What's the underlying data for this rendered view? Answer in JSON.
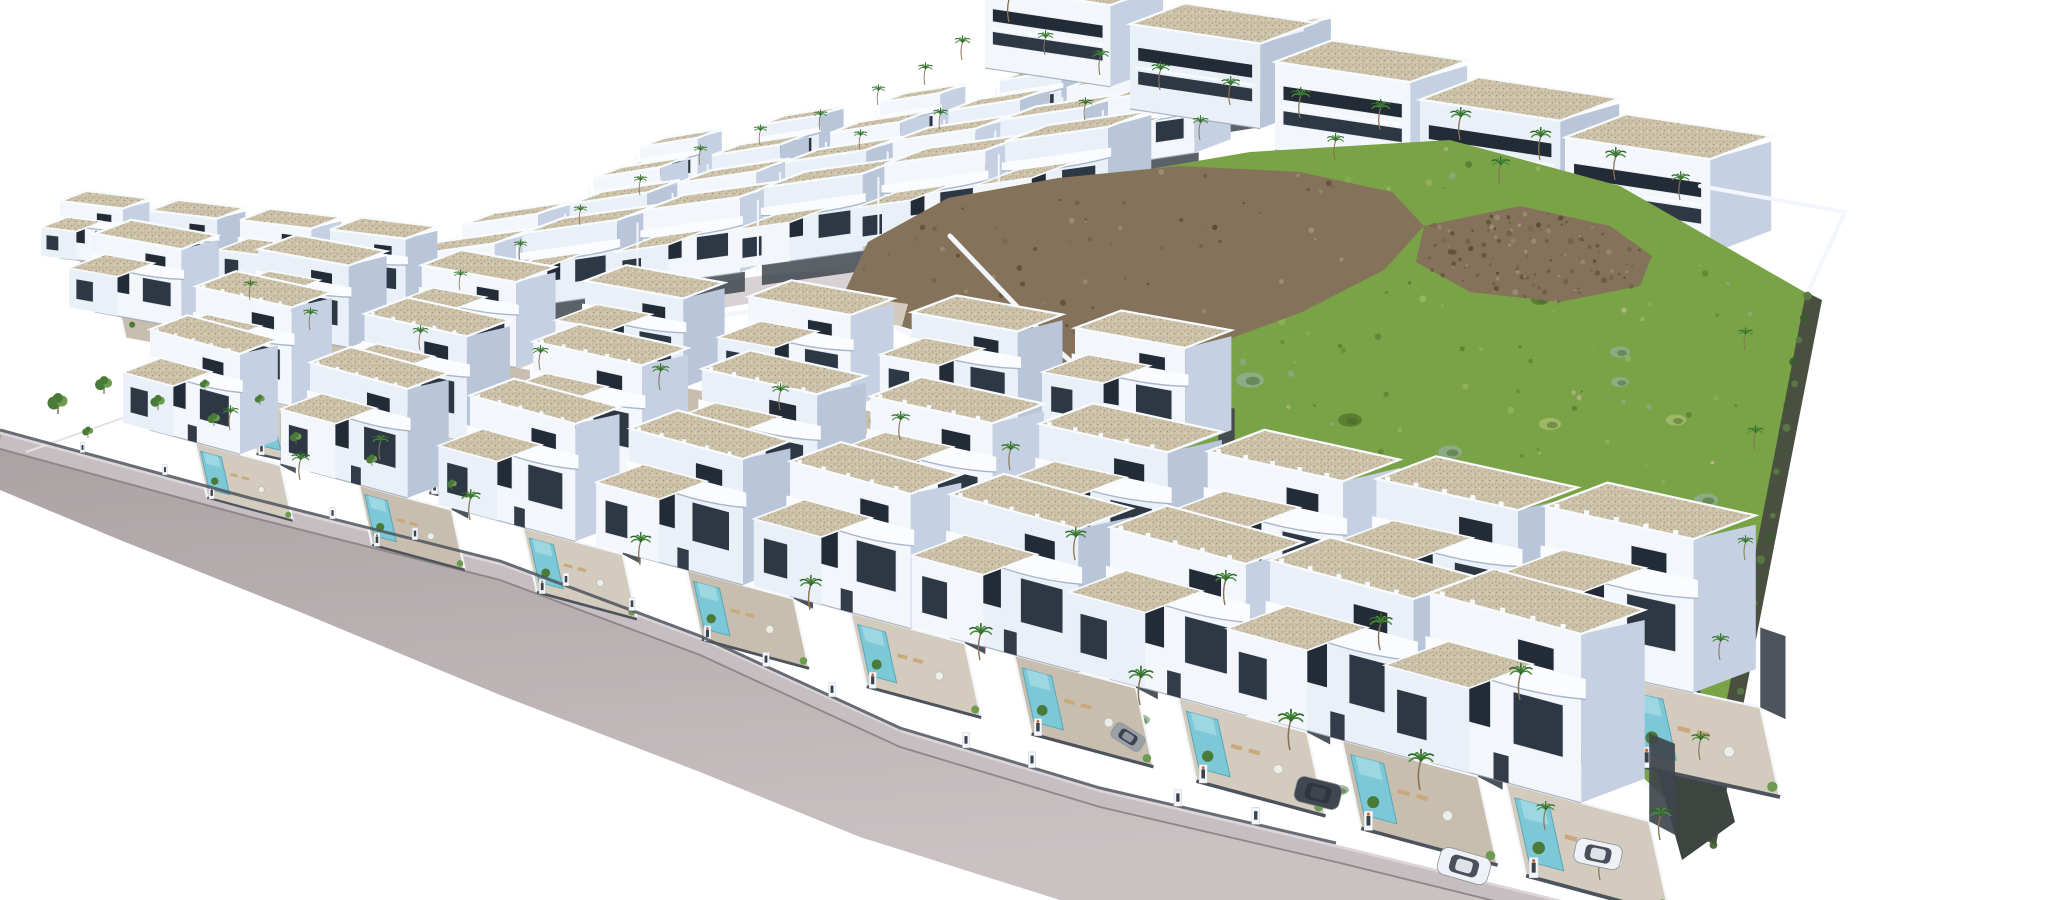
{
  "meta": {
    "description": "Aerial 3D architectural render of a coastal residential development: diagonal rows of white modern villas with gravel flat roofs, curved balconies, private turquoise pools and palm trees; a green undeveloped hillside lot with brown rocky outcrops on the right; a curving gray asphalt road along the lower-left edge; pure white background.",
    "canvas": {
      "w": 2048,
      "h": 900
    }
  },
  "palette": {
    "background": "#ffffff",
    "road_top": "#aaa1a3",
    "road_bottom": "#c9c1c2",
    "sidewalk": "#c6bec0",
    "curb": "#8f8688",
    "wall_base_line": "#ddd6d8",
    "inner_road": "#d8d2d4",
    "villa_front": "#f3f7fc",
    "villa_front_alt": "#eaf0f8",
    "villa_side": "#c5d1e2",
    "villa_side_alt": "#b9c6d9",
    "roof_gravel": "#cdc2aa",
    "parapet": "#f8fbfe",
    "base_shadow": "#98a3b2",
    "window": "#222b36",
    "window_alt": "#2e3844",
    "window_frame": "#e8edf4",
    "door": "#333c48",
    "balcony": "#fafcff",
    "balcony_shadow": "#a9b7c9",
    "fence": "#4d535d",
    "side_yard": "#3f454d",
    "pillar": "#f3f6fa",
    "pillar_slot": "#3a424c",
    "pillar_plant": "#c96a35",
    "paving": "#d3cbbd",
    "paving_alt": "#c7beb0",
    "pool": "#7cc8d6",
    "pool_light": "#aadde7",
    "pool_edge": "#58a8b8",
    "lounger": "#c9a87c",
    "table": "#eceee9",
    "field": "#7aa246",
    "field_dots": [
      "#55792f",
      "#93b05e",
      "#8fae8f",
      "#a6bc6c",
      "#c2b794",
      "#4f7430"
    ],
    "clump_colors": {
      "g": "#8fae8f",
      "d": "#55792f",
      "l": "#a6bc6c",
      "t": "#c2b794"
    },
    "rock": "#84735a",
    "rock_dots": [
      "#5d4f3c",
      "#a3927a",
      "#6e5f4a",
      "#57492f"
    ],
    "hedge": "#495040",
    "wedge": "#3e4440",
    "wall_white": "#f3f6fa",
    "palm_trunk": "#8a7355",
    "palm_dark": "#2e6629",
    "palm_light": "#4c8c3c",
    "tree": "#4a7a38",
    "tree_light": "#6d9c50",
    "car_colors": {
      "dark": "#41474e",
      "white": "#eef1f5",
      "gray": "#9aa0a6"
    },
    "car_glass": "#2b3340",
    "figure_colors": [
      "#8a4a3a",
      "#35507a",
      "#666666",
      "#7a6a4a"
    ]
  },
  "scene": {
    "road": {
      "top_edge": [
        [
          0,
          432
        ],
        [
          250,
          500
        ],
        [
          500,
          563
        ],
        [
          700,
          638
        ],
        [
          900,
          730
        ],
        [
          1100,
          790
        ],
        [
          1336,
          845
        ],
        [
          1560,
          900
        ]
      ],
      "bottom_edge": [
        [
          1060,
          900
        ],
        [
          860,
          837
        ],
        [
          700,
          772
        ],
        [
          500,
          695
        ],
        [
          300,
          612
        ],
        [
          120,
          540
        ],
        [
          0,
          490
        ]
      ]
    },
    "inner_road": {
      "path": "M 470,378 C 560,332 660,302 760,289 C 840,279 898,284 928,306 C 954,326 948,352 982,384 C 1008,408 1040,432 1078,456"
    },
    "curved_wall": {
      "path": "M 695,322 C 780,300 852,305 902,330 C 932,345 942,366 962,386"
    },
    "plaza": {
      "quad": [
        [
          852,
          296
        ],
        [
          908,
          304
        ],
        [
          902,
          326
        ],
        [
          846,
          318
        ]
      ],
      "figures": [
        [
          858,
          302
        ],
        [
          872,
          310
        ],
        [
          888,
          306
        ],
        [
          862,
          316
        ]
      ]
    },
    "field": {
      "outline": [
        [
          950,
          236
        ],
        [
          1050,
          186
        ],
        [
          1250,
          152
        ],
        [
          1450,
          140
        ],
        [
          1620,
          186
        ],
        [
          1808,
          294
        ],
        [
          1760,
          560
        ],
        [
          1706,
          838
        ],
        [
          1640,
          778
        ],
        [
          1470,
          656
        ],
        [
          1310,
          562
        ],
        [
          1180,
          456
        ],
        [
          1060,
          352
        ]
      ]
    },
    "rocks": [
      {
        "outline": [
          [
            840,
            302
          ],
          [
            868,
            242
          ],
          [
            948,
            198
          ],
          [
            1058,
            178
          ],
          [
            1180,
            166
          ],
          [
            1300,
            172
          ],
          [
            1392,
            192
          ],
          [
            1424,
            226
          ],
          [
            1384,
            270
          ],
          [
            1302,
            312
          ],
          [
            1216,
            344
          ],
          [
            1180,
            400
          ],
          [
            1130,
            432
          ],
          [
            1068,
            410
          ],
          [
            1002,
            362
          ],
          [
            920,
            332
          ],
          [
            868,
            316
          ]
        ]
      },
      {
        "outline": [
          [
            1424,
            226
          ],
          [
            1520,
            206
          ],
          [
            1610,
            226
          ],
          [
            1652,
            256
          ],
          [
            1640,
            286
          ],
          [
            1560,
            302
          ],
          [
            1470,
            292
          ],
          [
            1416,
            262
          ]
        ]
      }
    ],
    "field_clumps": [
      [
        1000,
        300,
        10,
        "g"
      ],
      [
        1060,
        420,
        14,
        "g"
      ],
      [
        1120,
        500,
        12,
        "d"
      ],
      [
        1200,
        560,
        16,
        "g"
      ],
      [
        1290,
        612,
        13,
        "d"
      ],
      [
        1380,
        650,
        16,
        "g"
      ],
      [
        1470,
        682,
        13,
        "d"
      ],
      [
        1560,
        692,
        15,
        "g"
      ],
      [
        1640,
        660,
        12,
        "g"
      ],
      [
        1688,
        600,
        11,
        "d"
      ],
      [
        1706,
        500,
        12,
        "g"
      ],
      [
        1676,
        420,
        10,
        "l"
      ],
      [
        1620,
        352,
        10,
        "g"
      ],
      [
        1540,
        300,
        9,
        "d"
      ],
      [
        1460,
        262,
        9,
        "g"
      ],
      [
        1360,
        240,
        9,
        "l"
      ],
      [
        1262,
        232,
        8,
        "g"
      ],
      [
        1160,
        252,
        8,
        "d"
      ],
      [
        1080,
        282,
        8,
        "g"
      ],
      [
        1150,
        330,
        12,
        "l"
      ],
      [
        1250,
        380,
        14,
        "g"
      ],
      [
        1350,
        420,
        12,
        "d"
      ],
      [
        1450,
        452,
        12,
        "g"
      ],
      [
        1550,
        424,
        11,
        "l"
      ],
      [
        1620,
        382,
        9,
        "g"
      ],
      [
        1262,
        480,
        16,
        "g"
      ],
      [
        1400,
        520,
        15,
        "d"
      ],
      [
        1520,
        552,
        13,
        "g"
      ],
      [
        1300,
        700,
        14,
        "g"
      ],
      [
        1450,
        730,
        13,
        "d"
      ],
      [
        1580,
        758,
        12,
        "g"
      ],
      [
        1200,
        650,
        12,
        "l"
      ],
      [
        1100,
        600,
        10,
        "g"
      ],
      [
        1030,
        520,
        9,
        "d"
      ],
      [
        990,
        430,
        8,
        "l"
      ],
      [
        1140,
        720,
        10,
        "g"
      ],
      [
        1240,
        760,
        10,
        "d"
      ],
      [
        1340,
        790,
        9,
        "g"
      ],
      [
        1430,
        614,
        10,
        "t"
      ],
      [
        1530,
        640,
        9,
        "t"
      ]
    ],
    "boundary_wall": {
      "points": [
        [
          950,
          236
        ],
        [
          1060,
          352
        ],
        [
          1180,
          456
        ],
        [
          1310,
          562
        ],
        [
          1470,
          656
        ],
        [
          1640,
          778
        ],
        [
          1704,
          838
        ]
      ]
    },
    "back_wall": {
      "points": [
        [
          1700,
          186
        ],
        [
          1845,
          212
        ],
        [
          1808,
          292
        ]
      ]
    },
    "right_hedge": {
      "outline": [
        [
          1806,
          292
        ],
        [
          1822,
          300
        ],
        [
          1716,
          845
        ],
        [
          1700,
          838
        ]
      ]
    },
    "dark_wedge": {
      "outline": [
        [
          1600,
          565
        ],
        [
          1656,
          525
        ],
        [
          1735,
          822
        ],
        [
          1682,
          860
        ]
      ]
    },
    "left_fence": {
      "points": [
        [
          26,
          452
        ],
        [
          180,
          398
        ]
      ]
    },
    "villa_rows": [
      {
        "id": "row-a",
        "type": "upper",
        "su": -0.16,
        "from": [
          640,
          192
        ],
        "to": [
          1240,
          86
        ],
        "count": 6,
        "w": 64,
        "h": 50,
        "s0": 0.9,
        "s1": 1.0,
        "phase": 0
      },
      {
        "id": "row-b",
        "type": "upper",
        "su": -0.16,
        "from": [
          558,
          236
        ],
        "to": [
          1185,
          124
        ],
        "count": 6,
        "w": 72,
        "h": 56,
        "s0": 0.92,
        "s1": 1.04,
        "phase": 0.3
      },
      {
        "id": "row-c",
        "type": "upper",
        "su": -0.15,
        "from": [
          462,
          284
        ],
        "to": [
          1108,
          166
        ],
        "count": 7,
        "w": 80,
        "h": 62,
        "s0": 0.95,
        "s1": 1.08,
        "phase": 0
      },
      {
        "id": "row-d",
        "type": "upper",
        "su": -0.14,
        "from": [
          372,
          334
        ],
        "to": [
          1005,
          222
        ],
        "count": 6,
        "w": 92,
        "h": 72,
        "s0": 1.0,
        "s1": 1.12,
        "phase": 0.25
      },
      {
        "id": "row-t",
        "type": "top",
        "su": 0.15,
        "from": [
          985,
          68
        ],
        "to": [
          1565,
          232
        ],
        "count": 5,
        "w": 132,
        "h": 86,
        "s0": 0.95,
        "s1": 1.1,
        "phase": 0
      },
      {
        "id": "row-e",
        "type": "mid",
        "su": 0.12,
        "from": [
          60,
          258
        ],
        "to": [
          330,
          298
        ],
        "count": 4,
        "w": 84,
        "h": 76,
        "s0": 0.75,
        "s1": 0.9,
        "phase": 0
      },
      {
        "id": "row-f",
        "type": "mid",
        "su": 0.18,
        "from": [
          95,
          312
        ],
        "to": [
          1075,
          428
        ],
        "count": 7,
        "w": 108,
        "h": 98,
        "s0": 0.8,
        "s1": 1.02,
        "phase": 0
      },
      {
        "id": "row-g",
        "type": "front",
        "su": 0.22,
        "from": [
          120,
          370
        ],
        "to": [
          1545,
          660
        ],
        "count": 9,
        "w": 116,
        "h": 120,
        "s0": 0.8,
        "s1": 1.28,
        "phase": 0.45,
        "dep": 70
      },
      {
        "id": "row-h",
        "type": "front",
        "su": 0.27,
        "from": [
          150,
          430
        ],
        "to": [
          1430,
          762
        ],
        "count": 9,
        "w": 120,
        "h": 134,
        "s0": 0.75,
        "s1": 1.26,
        "phase": 0,
        "dep": 74
      }
    ],
    "palms": [
      [
        1009,
        22,
        0.85
      ],
      [
        1045,
        55,
        0.6
      ],
      [
        962,
        60,
        0.6
      ],
      [
        925,
        85,
        0.55
      ],
      [
        878,
        105,
        0.5
      ],
      [
        1100,
        75,
        0.65
      ],
      [
        1160,
        90,
        0.7
      ],
      [
        1230,
        105,
        0.7
      ],
      [
        1300,
        118,
        0.75
      ],
      [
        1380,
        130,
        0.75
      ],
      [
        1460,
        140,
        0.8
      ],
      [
        1540,
        160,
        0.8
      ],
      [
        1615,
        180,
        0.8
      ],
      [
        1680,
        200,
        0.7
      ],
      [
        1085,
        120,
        0.55
      ],
      [
        1200,
        140,
        0.6
      ],
      [
        1335,
        160,
        0.65
      ],
      [
        1500,
        185,
        0.7
      ],
      [
        700,
        165,
        0.5
      ],
      [
        640,
        195,
        0.5
      ],
      [
        580,
        225,
        0.5
      ],
      [
        760,
        145,
        0.5
      ],
      [
        820,
        130,
        0.5
      ],
      [
        520,
        260,
        0.5
      ],
      [
        460,
        290,
        0.5
      ],
      [
        860,
        150,
        0.5
      ],
      [
        940,
        130,
        0.55
      ],
      [
        310,
        330,
        0.55
      ],
      [
        420,
        350,
        0.6
      ],
      [
        540,
        370,
        0.6
      ],
      [
        660,
        390,
        0.65
      ],
      [
        780,
        410,
        0.65
      ],
      [
        900,
        440,
        0.7
      ],
      [
        1010,
        470,
        0.7
      ],
      [
        250,
        300,
        0.5
      ],
      [
        1745,
        350,
        0.55
      ],
      [
        1755,
        450,
        0.6
      ],
      [
        1745,
        560,
        0.6
      ],
      [
        1720,
        660,
        0.65
      ],
      [
        1700,
        760,
        0.7
      ],
      [
        300,
        480,
        0.7
      ],
      [
        470,
        520,
        0.75
      ],
      [
        640,
        565,
        0.8
      ],
      [
        810,
        610,
        0.85
      ],
      [
        980,
        660,
        0.9
      ],
      [
        1140,
        705,
        0.95
      ],
      [
        1290,
        750,
        1.0
      ],
      [
        1420,
        790,
        1.0
      ],
      [
        1075,
        560,
        0.8
      ],
      [
        1225,
        605,
        0.85
      ],
      [
        1380,
        650,
        0.9
      ],
      [
        1520,
        700,
        0.9
      ],
      [
        230,
        430,
        0.6
      ],
      [
        380,
        460,
        0.65
      ],
      [
        1660,
        840,
        0.85
      ],
      [
        1600,
        880,
        0.75
      ],
      [
        1545,
        830,
        0.7
      ]
    ],
    "trees": [
      [
        58,
        414,
        1.0
      ],
      [
        104,
        394,
        0.85
      ],
      [
        158,
        410,
        0.72
      ],
      [
        214,
        426,
        0.62
      ],
      [
        88,
        438,
        0.55
      ],
      [
        296,
        444,
        0.58
      ],
      [
        372,
        466,
        0.55
      ],
      [
        452,
        490,
        0.5
      ],
      [
        205,
        390,
        0.5
      ],
      [
        260,
        405,
        0.5
      ]
    ],
    "cars": [
      {
        "x": 1318,
        "y": 793,
        "w": 46,
        "h": 26,
        "rot": 14,
        "color": "dark"
      },
      {
        "x": 1464,
        "y": 866,
        "w": 52,
        "h": 28,
        "rot": 16,
        "color": "white"
      },
      {
        "x": 1598,
        "y": 854,
        "w": 47,
        "h": 25,
        "rot": 12,
        "color": "white"
      },
      {
        "x": 1128,
        "y": 737,
        "w": 34,
        "h": 17,
        "rot": 32,
        "color": "gray"
      }
    ]
  }
}
